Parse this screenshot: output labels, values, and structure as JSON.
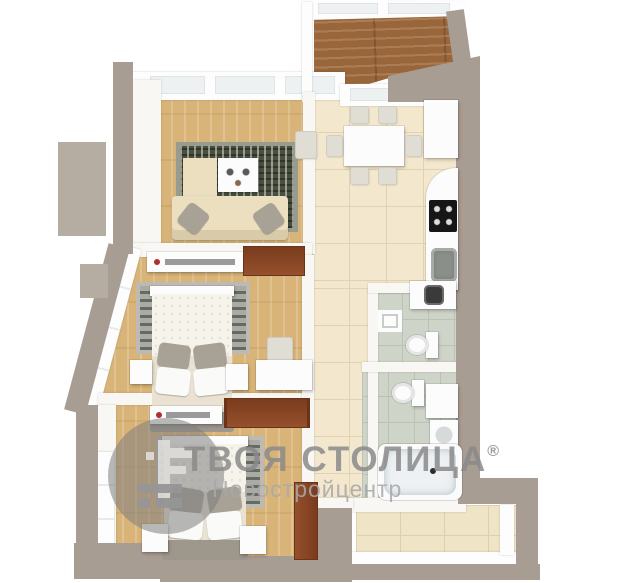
{
  "image": {
    "description": "3D top-down rendered floor plan of a two-bedroom apartment with watermark",
    "width": 622,
    "height": 583
  },
  "watermark": {
    "brand": "ТВОЯ СТОЛИЦА",
    "registered": "®",
    "subtitle": "Новостройцентр",
    "logo": "tvoya-stolitsa-circle-logo"
  },
  "scene": {
    "type": "floor-plan-3d-render",
    "rooms": [
      {
        "name": "living-room",
        "floor": "light-wood",
        "furniture": [
          "sofa",
          "coffee-table",
          "armchair-cabinet",
          "patterned-rug",
          "chair"
        ]
      },
      {
        "name": "kitchen-dining",
        "floor": "beige-tile",
        "furniture": [
          "dining-table",
          "six-chairs",
          "counter",
          "cooktop",
          "sink",
          "tall-cabinet"
        ]
      },
      {
        "name": "bedroom-middle",
        "floor": "light-wood",
        "furniture": [
          "double-bed",
          "rug",
          "two-nightstands",
          "tv-console",
          "desk",
          "chair",
          "door"
        ]
      },
      {
        "name": "bedroom-bottom",
        "floor": "light-wood",
        "furniture": [
          "double-bed",
          "rug",
          "two-nightstands",
          "tv-console",
          "wardrobe",
          "door"
        ]
      },
      {
        "name": "wc",
        "floor": "gray-tile",
        "furniture": [
          "washing-machine",
          "toilet",
          "small-sink"
        ]
      },
      {
        "name": "bathroom",
        "floor": "gray-tile",
        "furniture": [
          "toilet",
          "vanity",
          "sink",
          "bathtub"
        ]
      },
      {
        "name": "hallway",
        "floor": "beige-tile",
        "furniture": []
      },
      {
        "name": "terrace-top",
        "floor": "dark-wood-deck",
        "furniture": []
      },
      {
        "name": "loggia-bottom-right",
        "floor": "beige-tile",
        "furniture": []
      }
    ]
  },
  "palette": {
    "wall_exterior": "#a89d93",
    "wall_exterior_light": "#b5aca2",
    "wall_interior": "#f8f7f4",
    "floor_wood": "#d9b478",
    "floor_terrace_wood": "#99663c",
    "floor_tile_beige": "#f3e7cd",
    "floor_tile_gray": "#cfd4c9",
    "door_wood": "#8a4527",
    "sofa_cream": "#ecdfc0",
    "rug_dark": "#49503f",
    "rug_gray": "#adaaa4",
    "cooktop_black": "#161616",
    "accent_red_dot": "#b03030",
    "watermark_gray": "#8a8a8a"
  }
}
